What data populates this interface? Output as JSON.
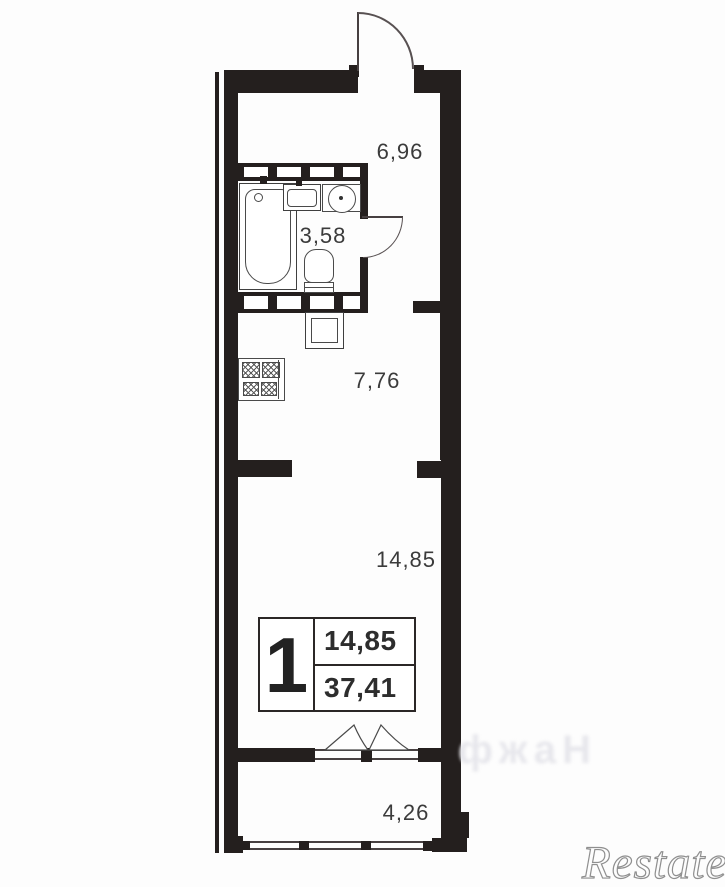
{
  "plan": {
    "rooms": [
      {
        "id": "hallway",
        "area": "6,96"
      },
      {
        "id": "bathroom",
        "area": "3,58"
      },
      {
        "id": "kitchen",
        "area": "7,76"
      },
      {
        "id": "living-room",
        "area": "14,85"
      },
      {
        "id": "balcony",
        "area": "4,26"
      }
    ],
    "summary": {
      "rooms_count": "1",
      "living_area": "14,85",
      "total_area": "37,41"
    }
  },
  "watermarks": {
    "brand": "Restate",
    "faint": "фжаН"
  },
  "colors": {
    "wall": "#241f1e",
    "line": "#3f3f3f",
    "label": "#3b3b3b",
    "watermark": "#8f8f8f"
  }
}
